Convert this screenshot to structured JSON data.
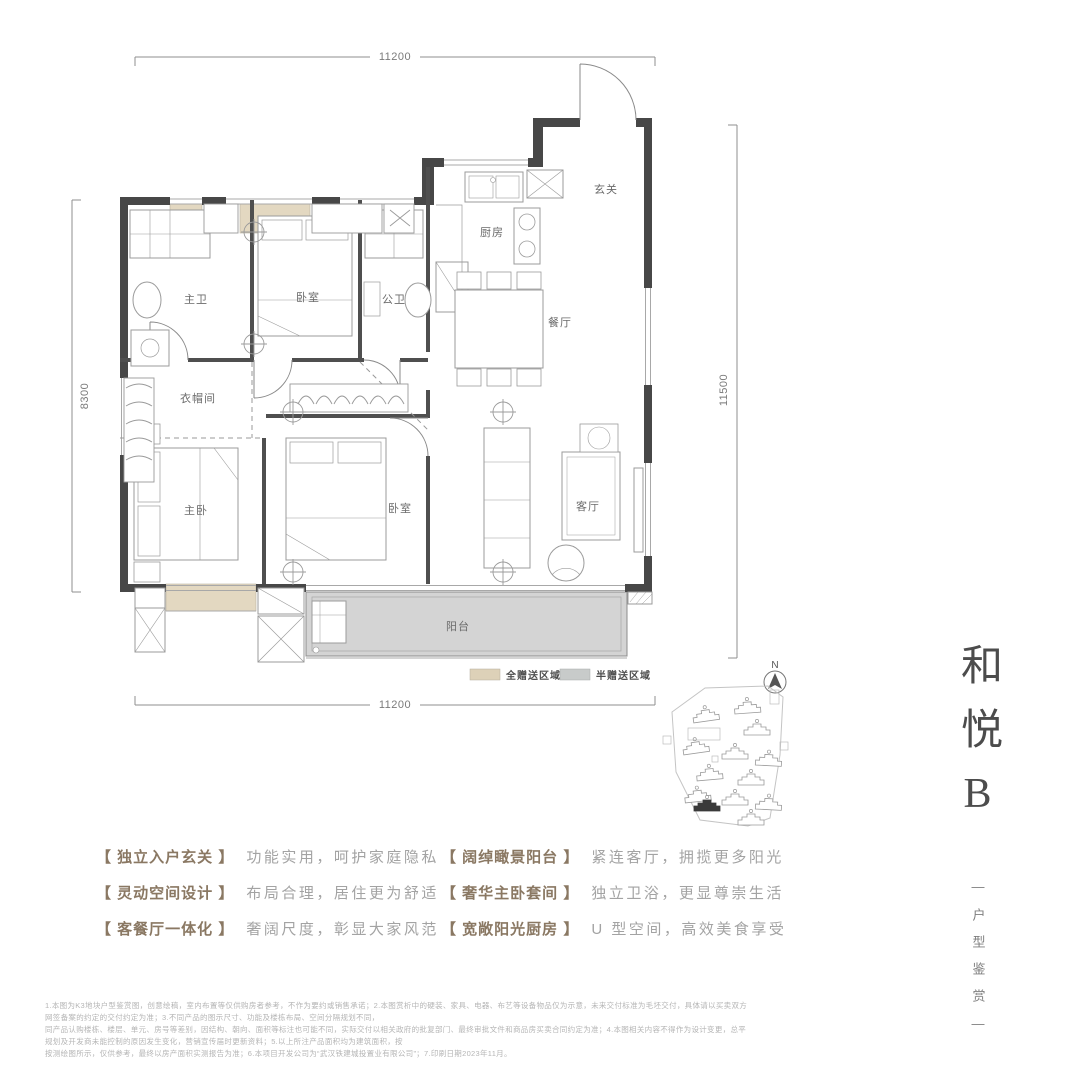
{
  "plan": {
    "rooms": {
      "entry": "玄关",
      "kitchen": "厨房",
      "dining": "餐厅",
      "living": "客厅",
      "master_bedroom": "主卧",
      "bedroom_top": "卧室",
      "bedroom_second": "卧室",
      "master_bath": "主卫",
      "guest_bath": "公卫",
      "cloakroom": "衣帽间",
      "balcony": "阳台"
    },
    "dimensions": {
      "top": "11200",
      "bottom": "11200",
      "left": "8300",
      "right": "11500"
    },
    "legend": [
      {
        "label": "全赠送区域",
        "color": "#ddd1b8"
      },
      {
        "label": "半赠送区域",
        "color": "#c8cbca"
      }
    ],
    "compass_label": "N",
    "colors": {
      "wall": "#474747",
      "gift_full": "#e3d8c1",
      "gift_half": "#d4d4d4"
    }
  },
  "title": {
    "name": "和悦B",
    "subtitle": "—户型鉴赏—"
  },
  "features": [
    {
      "title": "【 独立入户玄关 】",
      "desc": "功能实用，呵护家庭隐私"
    },
    {
      "title": "【 灵动空间设计 】",
      "desc": "布局合理，居住更为舒适"
    },
    {
      "title": "【 客餐厅一体化 】",
      "desc": "奢阔尺度，彰显大家风范"
    },
    {
      "title": "【 阔绰瞰景阳台 】",
      "desc": "紧连客厅，拥揽更多阳光"
    },
    {
      "title": "【 奢华主卧套间 】",
      "desc": "独立卫浴，更显尊崇生活"
    },
    {
      "title": "【 宽敞阳光厨房 】",
      "desc": "U 型空间，高效美食享受"
    }
  ],
  "disclaimer": {
    "line1": "1.本图为K3地块户型鉴赏图，创意绘稿，室内布置等仅供购房者参考，不作为要约或销售承诺；2.本图赏析中的硬装、家具、电器、布艺等设备物品仅为示意，未来交付标准为毛坯交付，具体请以买卖双方网签备案的约定的交付约定为准；3.不同产品的图示尺寸、功能及楼栋布局、空间分隔规划不同，",
    "line2": "同产品认购楼栋、楼层、单元、房号等差别，因结构、朝向、面积等标注也可能不同，实际交付以相关政府的批复部门、最终审批文件和商品房买卖合同约定为准；4.本图相关内容不得作为设计变更，总平规划及开发商未能控制的原因发生变化，营销宣传届时更新资料；5.以上所注产品面积均为建筑面积，按",
    "line3": "按测绘图所示，仅供参考，最终以房产面积实测报告为准；6.本项目开发公司为“武汉铁建城投置业有限公司”；7.印刷日期2023年11月。"
  }
}
